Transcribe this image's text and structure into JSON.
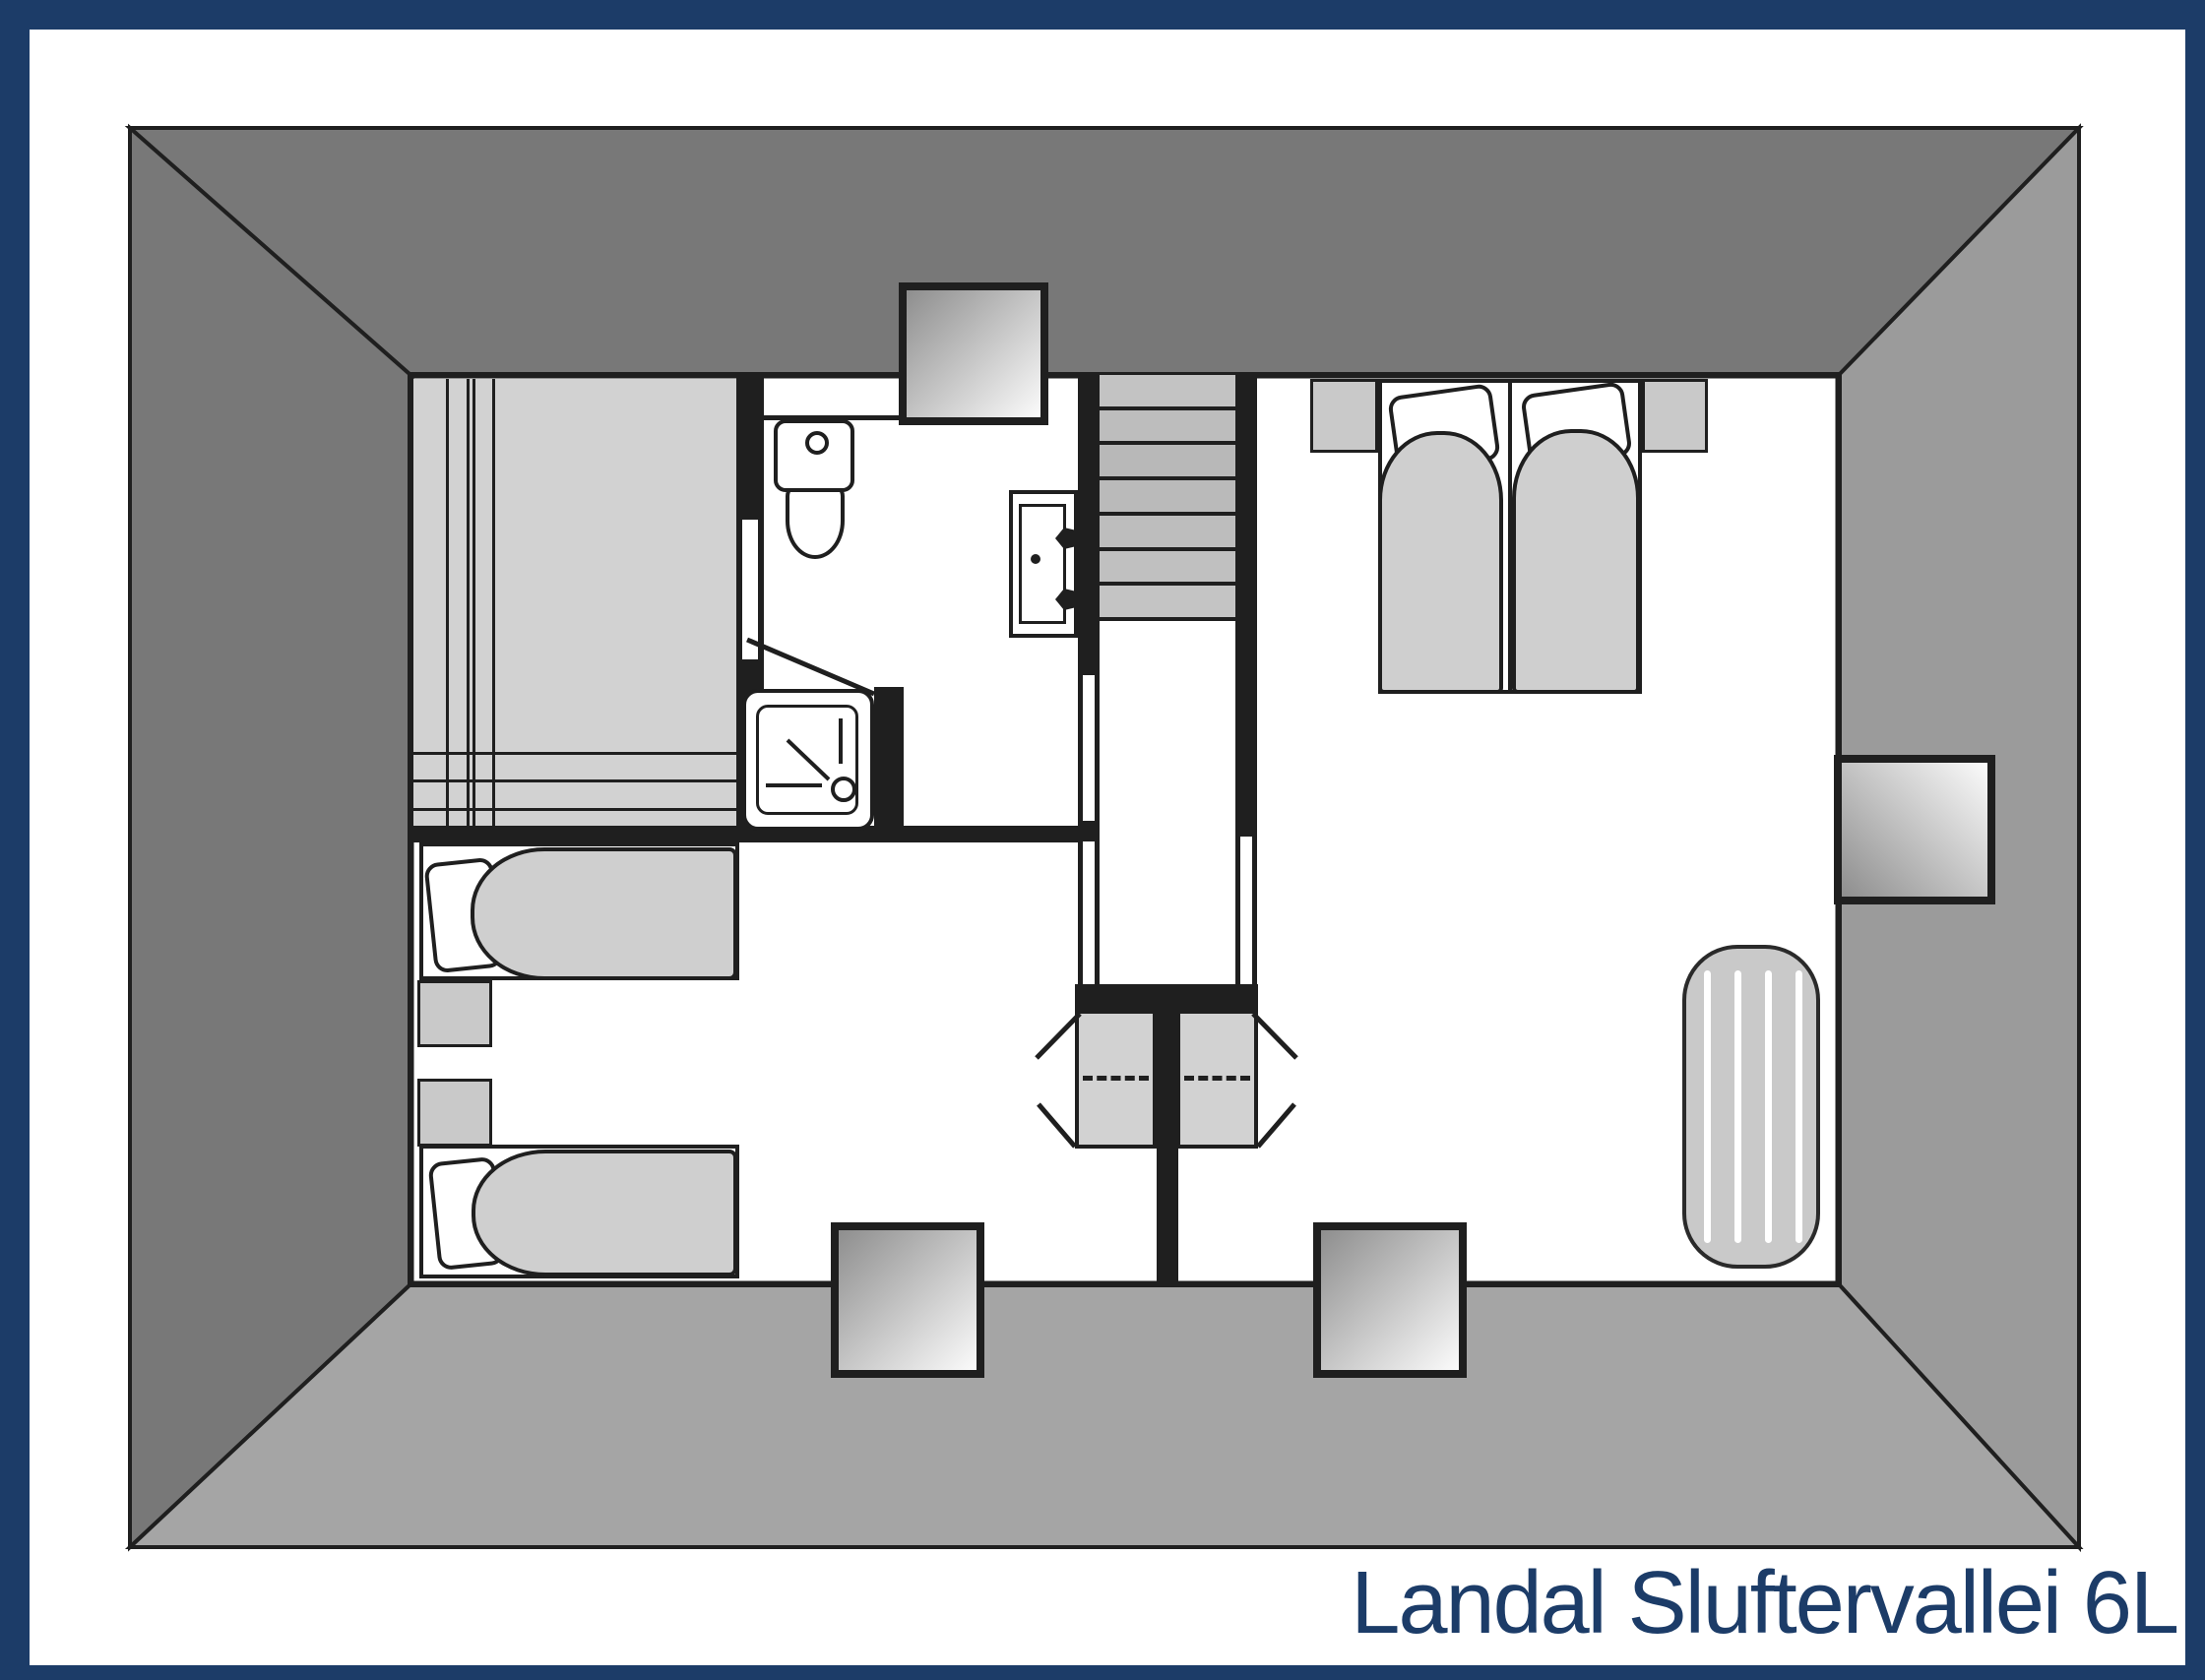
{
  "title": "Landal Sluftervallei 6L",
  "colors": {
    "frame": "#1c3c68",
    "page-bg": "#ffffff",
    "wall": "#1f1f1f",
    "floor": "#ffffff",
    "roof-dark": "#787878",
    "roof-right": "#9b9b9b",
    "roof-bottom": "#a5a5a5",
    "room-gray": "#d2d2d2",
    "furniture-gray": "#c9c9c9",
    "duvet-gray": "#cfcfcf",
    "mattress-gray": "#c9c9c9",
    "skylight-dark": "#8e8e8e",
    "skylight-light": "#fbfbfb",
    "title-text": "#1c3c68"
  }
}
